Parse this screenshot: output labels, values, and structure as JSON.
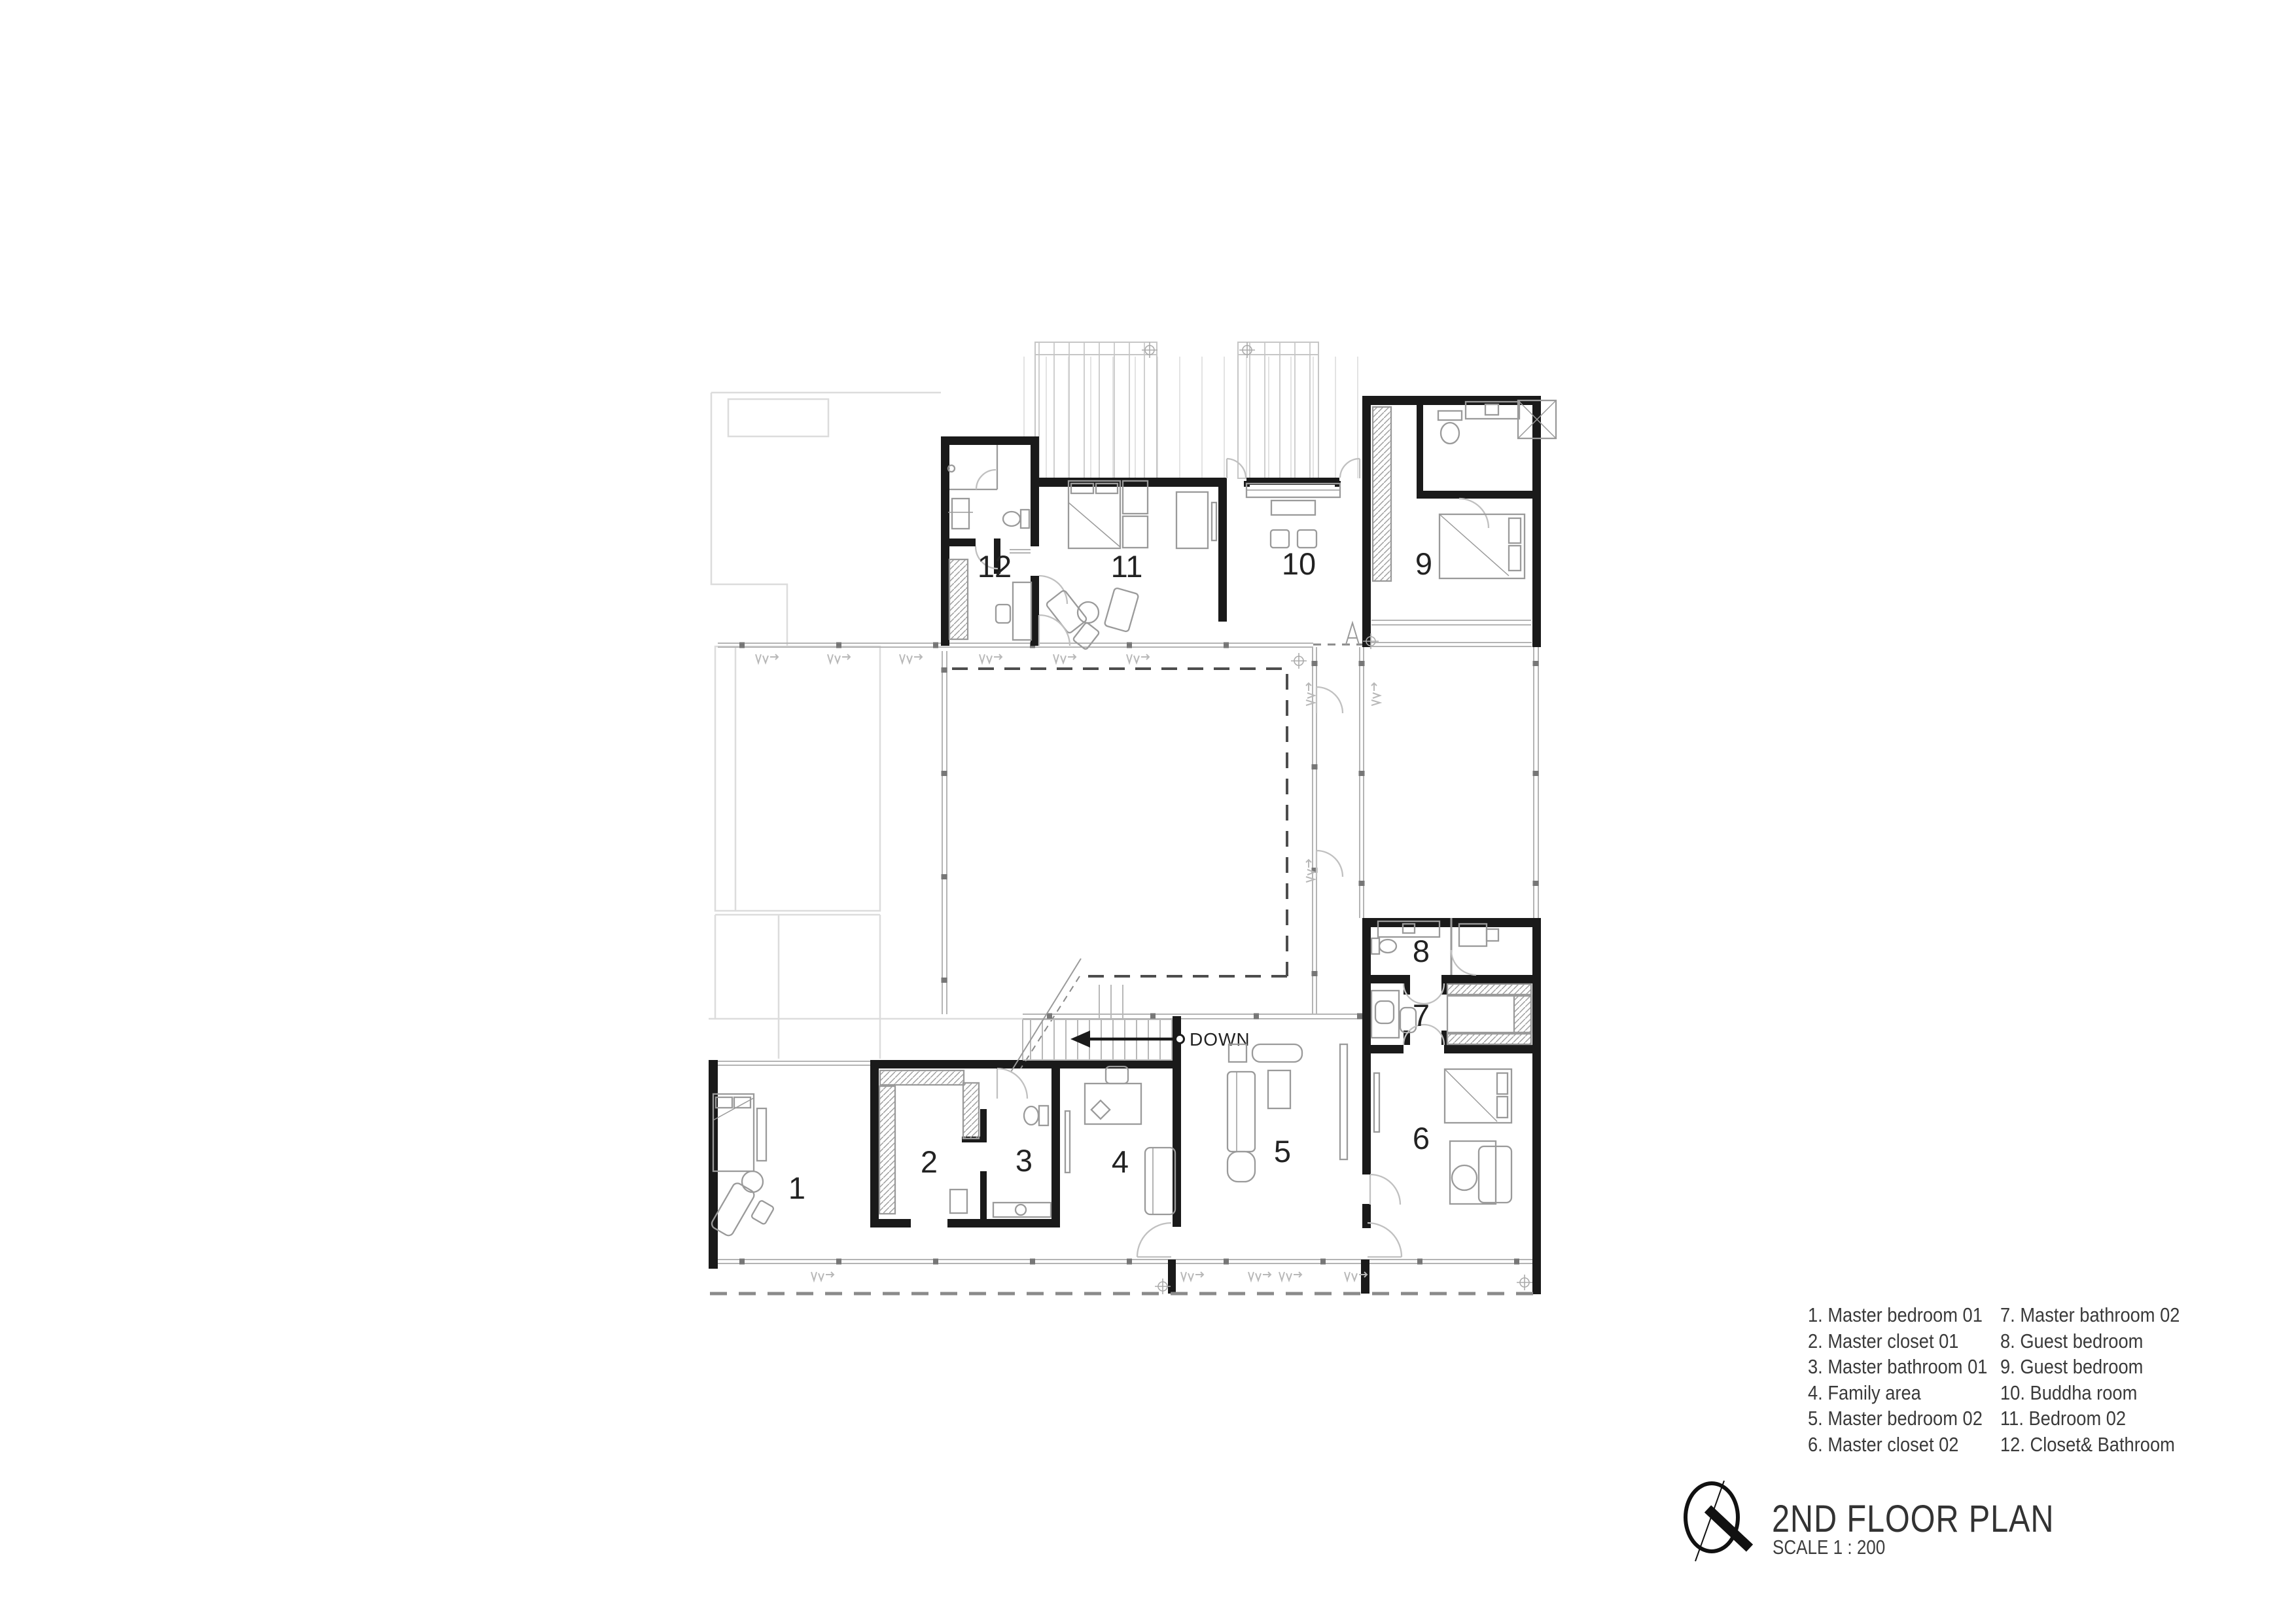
{
  "plan": {
    "down_label": "DOWN",
    "rooms": [
      {
        "number": "1",
        "name": "Master bedroom 01"
      },
      {
        "number": "2",
        "name": "Master closet 01"
      },
      {
        "number": "3",
        "name": "Master bathroom 01"
      },
      {
        "number": "4",
        "name": "Family area"
      },
      {
        "number": "5",
        "name": "Master bedroom 02"
      },
      {
        "number": "6",
        "name": "Master closet 02"
      },
      {
        "number": "7",
        "name": "Master bathroom 02"
      },
      {
        "number": "8",
        "name": "Guest bedroom"
      },
      {
        "number": "9",
        "name": "Guest bedroom"
      },
      {
        "number": "10",
        "name": "Buddha room"
      },
      {
        "number": "11",
        "name": "Bedroom 02"
      },
      {
        "number": "12",
        "name": "Closet& Bathroom"
      }
    ]
  },
  "legend": {
    "col1": [
      "1. Master bedroom 01",
      "2. Master closet 01",
      "3. Master bathroom 01",
      "4. Family area",
      "5. Master bedroom 02",
      "6. Master closet 02"
    ],
    "col2": [
      "7. Master bathroom 02",
      "8. Guest bedroom",
      "9. Guest bedroom",
      "10. Buddha room",
      "11. Bedroom 02",
      "12. Closet& Bathroom"
    ]
  },
  "title_block": {
    "title": "2ND FLOOR PLAN",
    "scale": "SCALE 1 : 200",
    "north_icon": "compass-north-icon"
  },
  "colors": {
    "wall": "#1a1a1a",
    "furniture_line": "#9a9a9a",
    "glazing_line": "#b4b4b4",
    "faint_line": "#dcdcdc",
    "dash_dark": "#4d4d4d",
    "dash_roof": "#8a8a8a",
    "text": "#303030"
  }
}
